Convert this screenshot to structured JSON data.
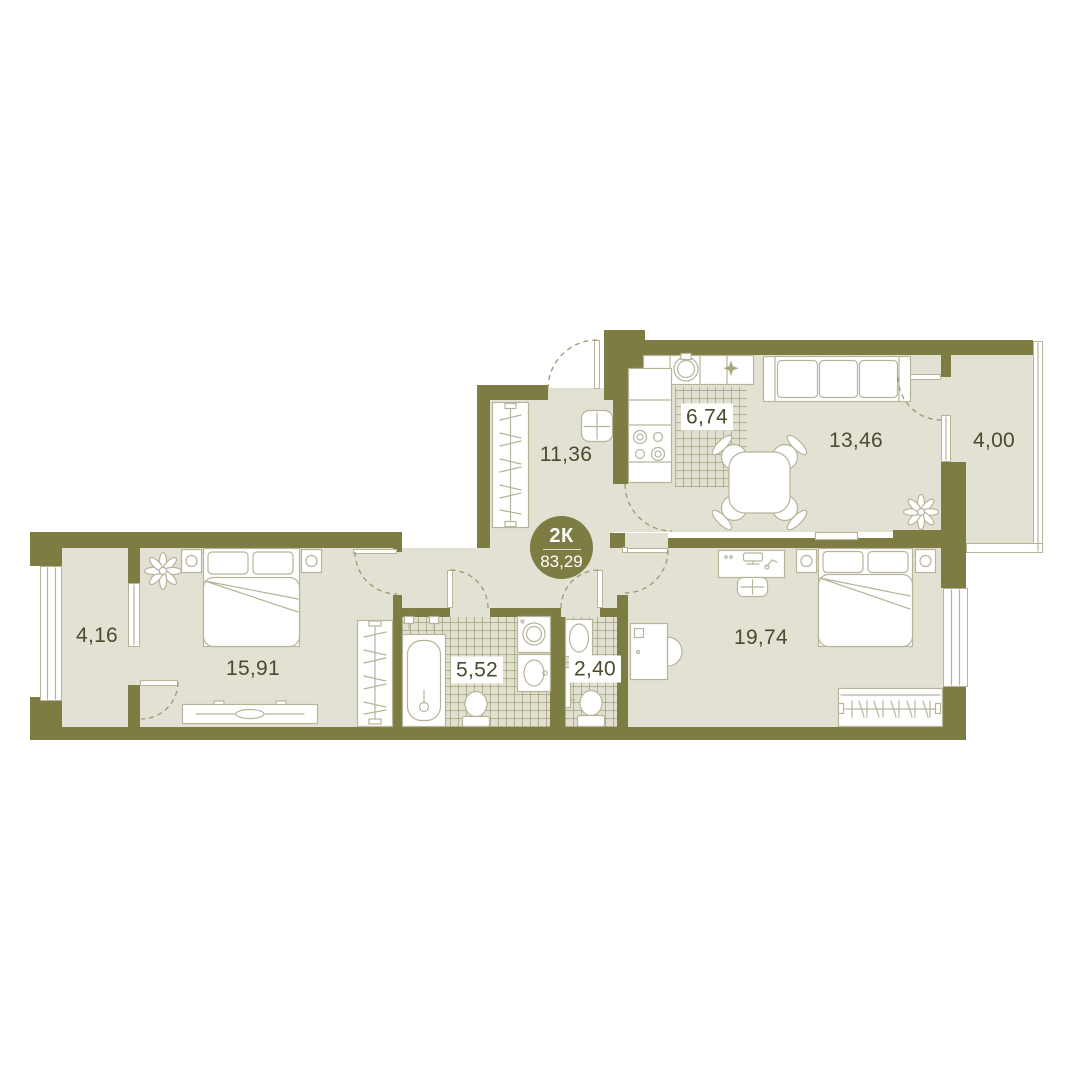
{
  "plan": {
    "badge": {
      "type": "2К",
      "area": "83,29"
    },
    "rooms": [
      {
        "id": "hallway",
        "area": "11,36"
      },
      {
        "id": "kitchen",
        "area": "6,74"
      },
      {
        "id": "living-room",
        "area": "13,46"
      },
      {
        "id": "balcony-right",
        "area": "4,00"
      },
      {
        "id": "balcony-left",
        "area": "4,16"
      },
      {
        "id": "bedroom",
        "area": "15,91"
      },
      {
        "id": "bathroom",
        "area": "5,52"
      },
      {
        "id": "wc",
        "area": "2,40"
      },
      {
        "id": "master-bedroom",
        "area": "19,74"
      }
    ],
    "colors": {
      "wall": "#7d7c43",
      "floor": "#e3e1d3",
      "furniture_outline": "#b7b49a",
      "door_arc": "#9b996f",
      "label_text": "#4b4a2e",
      "badge_background": "#7d7c43",
      "label_chip_background": "#ffffff",
      "page_background": "#ffffff"
    }
  }
}
